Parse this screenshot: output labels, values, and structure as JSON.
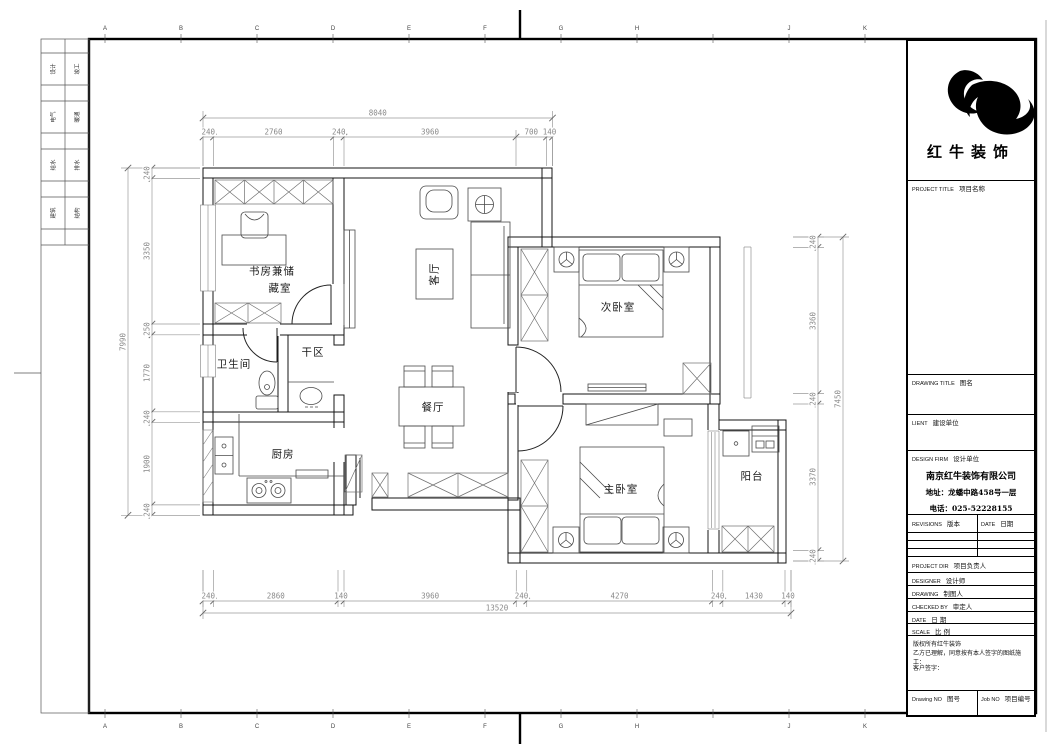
{
  "sheet": {
    "grid_letters": [
      {
        "l": "A",
        "x": 105
      },
      {
        "l": "B",
        "x": 181
      },
      {
        "l": "C",
        "x": 257
      },
      {
        "l": "D",
        "x": 333
      },
      {
        "l": "E",
        "x": 409
      },
      {
        "l": "F",
        "x": 485
      },
      {
        "l": "G",
        "x": 561
      },
      {
        "l": "H",
        "x": 637
      },
      {
        "l": "J",
        "x": 789
      },
      {
        "l": "K",
        "x": 865
      }
    ],
    "extra_tick_x": 713,
    "side_strip_rows": [
      {
        "c1": "设计",
        "c2": "竣工",
        "y": 69
      },
      {
        "c1": "电气",
        "c2": "暖通",
        "y": 117
      },
      {
        "c1": "给水",
        "c2": "排水",
        "y": 165
      },
      {
        "c1": "建筑",
        "c2": "结构",
        "y": 213
      }
    ]
  },
  "title_block": {
    "brand": "红牛装饰",
    "project_title_en": "PROJECT TITLE",
    "project_title_cn": "项目名称",
    "drawing_title_en": "DRAWING TITLE",
    "drawing_title_cn": "图名",
    "client_en": "LIENT",
    "client_cn": "建设单位",
    "design_firm_en": "DESIGN FIRM",
    "design_firm_cn": "设计单位",
    "company": {
      "name": "南京红牛装饰有限公司",
      "address": "地址：龙蟠中路458号一层",
      "phone": "电话：025-52228155"
    },
    "revisions_en": "REVISIONS",
    "revisions_cn": "版本",
    "date_col_en": "DATE",
    "date_col_cn": "日期",
    "rows": [
      {
        "en": "PROJECT DIR",
        "cn": "项目负责人"
      },
      {
        "en": "DESIGNER",
        "cn": "设计师"
      },
      {
        "en": "DRAWING",
        "cn": "制图人"
      },
      {
        "en": "CHECKED BY",
        "cn": "审定人"
      },
      {
        "en": "DATE",
        "cn": "日  期"
      },
      {
        "en": "SCALE",
        "cn": "比  例"
      }
    ],
    "copyright_line1": "版权所有红牛装饰",
    "copyright_line2": "乙方已理解，同意按有本人签字的图纸施工：",
    "signature_label": "客户签字：",
    "drawing_no_en": "Drawing NO",
    "drawing_no_cn": "图号",
    "job_no_en": "Job NO",
    "job_no_cn": "项目编号"
  },
  "floor_plan": {
    "room_labels": [
      {
        "text": "书房兼储",
        "x": 272,
        "y": 271
      },
      {
        "text": "藏室",
        "x": 280,
        "y": 288
      },
      {
        "text": "卫生间",
        "x": 234,
        "y": 364
      },
      {
        "text": "干区",
        "x": 313,
        "y": 352
      },
      {
        "text": "厨房",
        "x": 283,
        "y": 454
      },
      {
        "text": "客厅",
        "x": 434,
        "y": 274,
        "rot": -90
      },
      {
        "text": "餐厅",
        "x": 433,
        "y": 407
      },
      {
        "text": "次卧室",
        "x": 618,
        "y": 307
      },
      {
        "text": "主卧室",
        "x": 621,
        "y": 489
      },
      {
        "text": "阳台",
        "x": 752,
        "y": 476
      }
    ]
  },
  "dimensions": {
    "chains": [
      {
        "dir": "h",
        "line": 137,
        "ext": [
          130,
          166
        ],
        "b": [
          203,
          213.5,
          333.5,
          344,
          516,
          546.5,
          552.5
        ],
        "labels": [
          "240",
          "2760",
          "240",
          "3960",
          "700",
          "140"
        ]
      },
      {
        "dir": "h",
        "line": 118,
        "ext": [
          111,
          166
        ],
        "b": [
          203,
          552.5
        ],
        "labels": [
          "8040"
        ]
      },
      {
        "dir": "v",
        "line": 152,
        "ext": [
          146,
          200
        ],
        "b": [
          168,
          178.5,
          324,
          334.8,
          411.8,
          422.3,
          504.9,
          515.3
        ],
        "labels": [
          "240",
          "3350",
          "250",
          "1770",
          "240",
          "1900",
          "240"
        ]
      },
      {
        "dir": "v",
        "line": 128,
        "ext": [
          121,
          200
        ],
        "b": [
          168,
          515.3
        ],
        "labels": [
          "7990"
        ]
      },
      {
        "dir": "v",
        "line": 818,
        "ext": [
          793,
          824
        ],
        "b": [
          237,
          247.4,
          393.6,
          404,
          550.6,
          561
        ],
        "labels": [
          "240",
          "3360",
          "240",
          "3370",
          "240"
        ]
      },
      {
        "dir": "v",
        "line": 843,
        "ext": [
          793,
          849
        ],
        "b": [
          237,
          561
        ],
        "labels": [
          "7450"
        ]
      },
      {
        "dir": "h",
        "line": 601,
        "ext": [
          570,
          607
        ],
        "b": [
          203,
          213.5,
          338,
          344,
          516.3,
          526.7,
          712.4,
          722.8,
          785,
          791
        ],
        "labels": [
          "240",
          "2860",
          "140",
          "3960",
          "240",
          "4270",
          "240",
          "1430",
          "140"
        ]
      },
      {
        "dir": "h",
        "line": 613,
        "ext": [
          570,
          619
        ],
        "b": [
          203,
          791
        ],
        "labels": [
          "13520"
        ]
      }
    ]
  }
}
